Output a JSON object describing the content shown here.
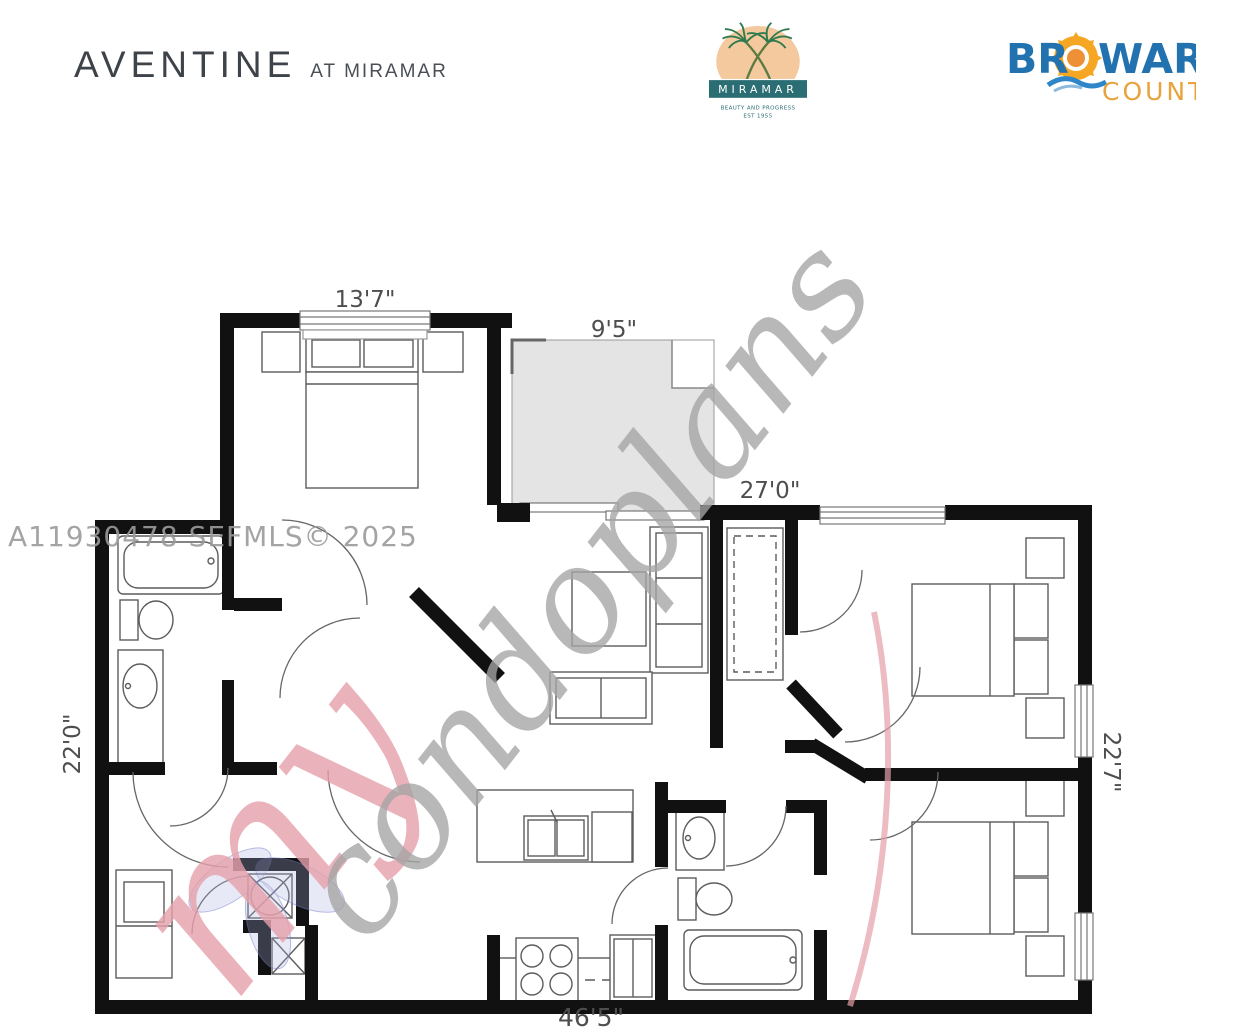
{
  "header": {
    "title": "AVENTINE",
    "subtitle": "AT MIRAMAR",
    "miramar": {
      "name": "MIRAMAR",
      "tagline": "BEAUTY AND PROGRESS",
      "est": "EST 1955"
    },
    "broward": {
      "part1": "BR",
      "part2": "WARD",
      "county": "COUNTY"
    }
  },
  "floorplan": {
    "dimensions": {
      "master_width": "13'7\"",
      "balcony_width": "9'5\"",
      "right_width": "27'0\"",
      "left_height": "22'0\"",
      "right_height": "22'7\"",
      "total_width": "46'5\""
    },
    "watermarks": {
      "mls": "A11930478  SEFMLS© 2025",
      "script_my": "my",
      "script_rest": "condoplans"
    },
    "colors": {
      "wall": "#111111",
      "balcony_fill": "#e4e4e4",
      "dimension_text": "#4e4e4e",
      "watermark_gray": "#a5a5a5",
      "watermark_pink": "#e6a0aa",
      "miramar_teal": "#2a6e74",
      "miramar_peach": "#f3c99d",
      "broward_blue": "#2272b0",
      "broward_orange": "#e8a33c"
    }
  }
}
